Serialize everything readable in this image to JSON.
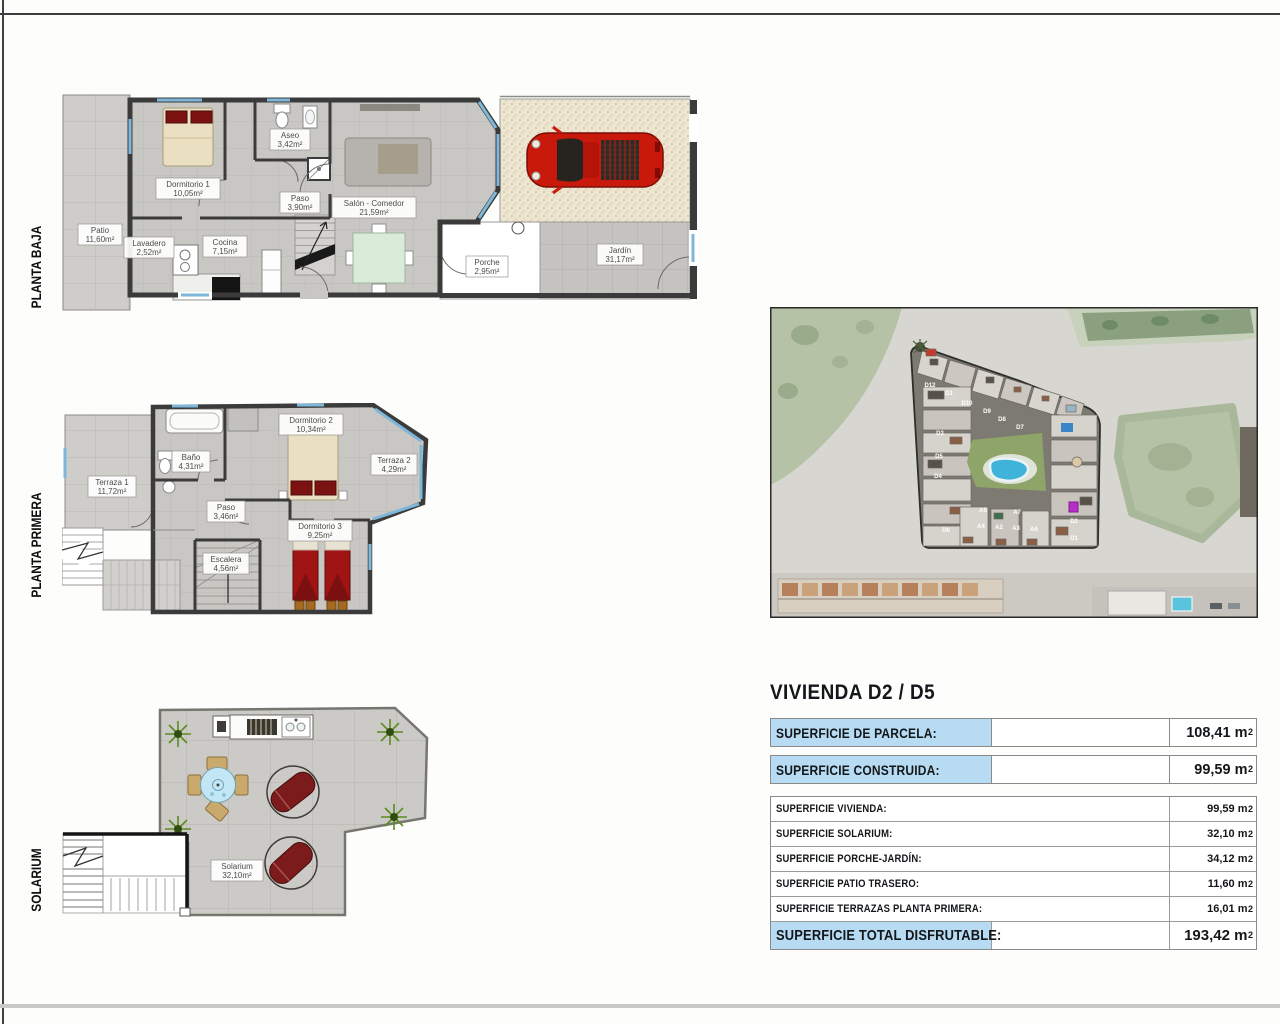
{
  "plans": {
    "baja": {
      "label": "PLANTA BAJA",
      "rooms": [
        {
          "name": "Dormitorio 1",
          "area": "10,05m²"
        },
        {
          "name": "Aseo",
          "area": "3,42m²"
        },
        {
          "name": "Paso",
          "area": "3,90m²"
        },
        {
          "name": "Salón - Comedor",
          "area": "21,59m²"
        },
        {
          "name": "Patio",
          "area": "11,60m²"
        },
        {
          "name": "Lavadero",
          "area": "2,52m²"
        },
        {
          "name": "Cocina",
          "area": "7,15m²"
        },
        {
          "name": "Porche",
          "area": "2,95m²"
        },
        {
          "name": "Jardín",
          "area": "31,17m²"
        }
      ]
    },
    "primera": {
      "label": "PLANTA PRIMERA",
      "rooms": [
        {
          "name": "Terraza 1",
          "area": "11,72m²"
        },
        {
          "name": "Baño",
          "area": "4,31m²"
        },
        {
          "name": "Dormitorio 2",
          "area": "10,34m²"
        },
        {
          "name": "Terraza 2",
          "area": "4,29m²"
        },
        {
          "name": "Paso",
          "area": "3,46m²"
        },
        {
          "name": "Escalera",
          "area": "4,56m²"
        },
        {
          "name": "Dormitorio 3",
          "area": "9,25m²"
        }
      ]
    },
    "solarium": {
      "label": "SOLARIUM",
      "rooms": [
        {
          "name": "Solarium",
          "area": "32,10m²"
        }
      ]
    }
  },
  "site": {
    "unit_labels": [
      "D12",
      "D1",
      "D10",
      "D9",
      "D8",
      "D7",
      "D3",
      "D5",
      "D4",
      "D6",
      "A5",
      "A4",
      "A7",
      "A2",
      "A3",
      "A6",
      "D2",
      "D1"
    ]
  },
  "summary": {
    "title": "VIVIENDA D2 / D5",
    "parcela": {
      "label": "SUPERFICIE DE PARCELA:",
      "value": "108,41 m",
      "sup": "2"
    },
    "construida": {
      "label": "SUPERFICIE CONSTRUIDA:",
      "value": "99,59 m",
      "sup": "2"
    },
    "rows": [
      {
        "label": "SUPERFICIE VIVIENDA:",
        "value": "99,59 m",
        "sup": "2"
      },
      {
        "label": "SUPERFICIE SOLARIUM:",
        "value": "32,10 m",
        "sup": "2"
      },
      {
        "label": "SUPERFICIE PORCHE-JARDÍN:",
        "value": "34,12 m",
        "sup": "2"
      },
      {
        "label": "SUPERFICIE PATIO TRASERO:",
        "value": "11,60 m",
        "sup": "2"
      },
      {
        "label": "SUPERFICIE TERRAZAS PLANTA PRIMERA:",
        "value": "16,01 m",
        "sup": "2"
      }
    ],
    "total": {
      "label": "SUPERFICIE TOTAL DISFRUTABLE:",
      "value": "193,42 m",
      "sup": "2"
    }
  },
  "colors": {
    "highlight_blue": "#b7dbf2",
    "wall_dark": "#3b3b3b",
    "floor_gray": "#c9c7c3",
    "car_red": "#c9190b",
    "bed_red": "#a01414",
    "pool_blue": "#3fb3d9",
    "grass_green": "#b5c2a5"
  }
}
